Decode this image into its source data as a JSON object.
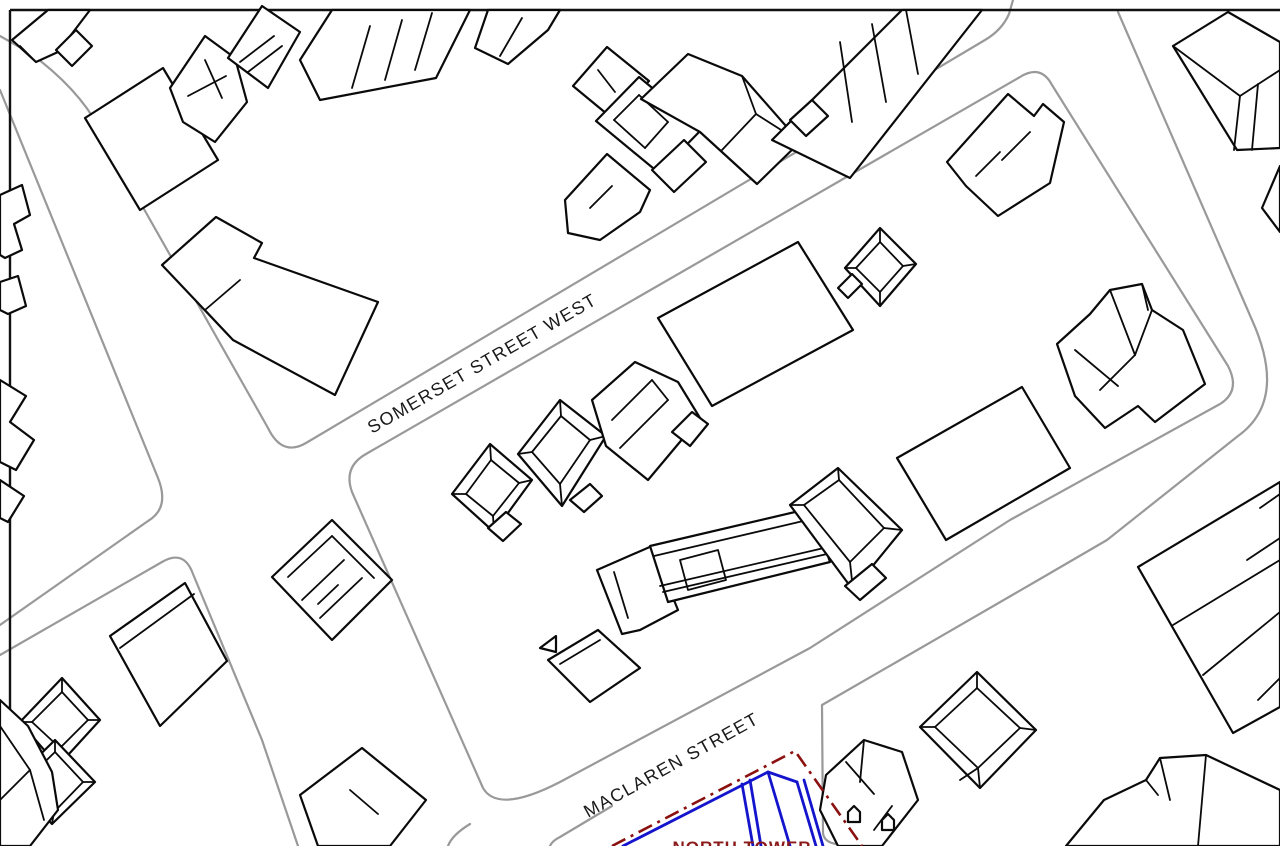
{
  "labels": {
    "somerset": {
      "text": "SOMERSET STREET WEST",
      "x": 372,
      "y": 434,
      "rotate": -30,
      "size": 18,
      "spacing": 1.4,
      "color": "#1a1a1a",
      "weight": "normal",
      "anchor": "start"
    },
    "maclaren": {
      "text": "MACLAREN STREET",
      "x": 588,
      "y": 818,
      "rotate": -29,
      "size": 18,
      "spacing": 1.4,
      "color": "#1a1a1a",
      "weight": "normal",
      "anchor": "start"
    },
    "tower": {
      "text": "NORTH TOWER",
      "x": 742,
      "y": 853,
      "rotate": 0,
      "size": 17,
      "spacing": 1,
      "color": "#8b1a1a",
      "weight": "bold",
      "anchor": "middle"
    }
  },
  "colors": {
    "background": "#ffffff",
    "building_stroke": "#0a0a0a",
    "building_fill": "#ffffff",
    "street_stroke": "#999999",
    "border_stroke": "#111111",
    "boundary_red": "#8b1111",
    "parcel_blue": "#1414cc"
  },
  "strokes": {
    "building_width": 2.2,
    "detail_width": 1.8,
    "street_width": 2.2,
    "border_width": 2.4,
    "red_width": 2.6,
    "blue_width": 2.8,
    "red_dash": "15 6 3 6"
  },
  "map": {
    "border_lines": [
      "10,10 1280,10",
      "10,10 10,846"
    ],
    "streets": [
      {
        "id": "street-topleft-corner-and-somerset-north-curb",
        "d": "M 0 36 L 30 53 Q 86 94 106 142 L 268 428 Q 282 457 306 443 L 985 40 Q 1002 30 1009 14 L 1013 0"
      },
      {
        "id": "street-left-cross-west-curb-upper",
        "d": "M 0 90 L 158 478 Q 170 508 148 521 L 0 625"
      },
      {
        "id": "street-somerset-south-curb-left-and-west-curb-lower",
        "d": "M 0 655 L 162 562 Q 184 549 193 574 L 262 740 L 298 846"
      },
      {
        "id": "street-block-loop-somerset-south-maclaren-north",
        "d": "M 352 492 Q 343 467 366 454 L 1020 77 Q 1041 64 1052 85 L 1228 366 Q 1241 391 1220 404 L 1010 520 L 810 648 L 560 782 Q 498 814 483 788 L 352 492"
      },
      {
        "id": "street-right-cross-east-curb-and-maclaren-south-curb",
        "d": "M 1118 12 L 1252 320 Q 1288 400 1238 436 L 1107 540 L 1040 579 L 900 660 L 822 705 L 823 833 Q 824 842 836 844 L 848 846"
      },
      {
        "id": "street-maclaren-south-curb-west-piece",
        "d": "M 612 806 L 560 837 Q 552 841 550 846"
      },
      {
        "id": "street-maclaren-southwest-corner-piece",
        "d": "M 470 824 Q 452 835 448 846"
      }
    ],
    "buildings": [
      {
        "id": "building-topleft-band",
        "outline": "12,40 48,10 90,10 58,52 36,62",
        "lines": [
          "36,62 20,46"
        ]
      },
      {
        "id": "building-topleft-small-square",
        "outline": "56,50 76,30 92,46 72,66",
        "lines": []
      },
      {
        "id": "building-large-rect-topleft",
        "outline": "85,118 163,68 218,160 140,210",
        "lines": []
      },
      {
        "id": "building-ornate-house-topleft",
        "outline": "170,88 205,36 235,58 247,102 215,142 183,122",
        "lines": [
          "205,60 222,98",
          "188,96 226,76"
        ]
      },
      {
        "id": "building-striped-house-top",
        "outline": "228,58 262,6 300,32 268,88",
        "lines": [
          "240,62 274,36",
          "248,72 282,46"
        ]
      },
      {
        "id": "building-wide-slab-top",
        "outline": "300,60 332,10 470,10 436,78 320,100",
        "lines": [
          "352,88 370,26",
          "385,80 402,20",
          "415,70 432,13"
        ]
      },
      {
        "id": "building-small-slab-top",
        "outline": "475,48 488,10 560,10 548,30 508,64",
        "lines": [
          "500,56 522,18"
        ]
      },
      {
        "id": "building-cluster-top-center-a",
        "outline": "573,86 607,47 649,81 613,119",
        "lines": [
          "598,70 615,92"
        ]
      },
      {
        "id": "building-cluster-top-center-b",
        "outline": "596,121 639,77 702,129 659,173",
        "lines": [
          "614,120 639,95",
          "639,95 668,122",
          "668,122 645,148",
          "645,148 614,120"
        ]
      },
      {
        "id": "building-cluster-top-center-c",
        "outline": "641,99 688,54 742,76 800,142 757,184 700,132",
        "lines": [
          "742,76 756,114",
          "756,114 800,142",
          "756,114 722,150"
        ]
      },
      {
        "id": "building-cluster-top-center-d",
        "outline": "565,200 607,154 650,190 640,212 600,240 568,233",
        "lines": [
          "590,208 612,186"
        ]
      },
      {
        "id": "building-cluster-top-center-e",
        "outline": "652,170 684,140 706,162 674,192",
        "lines": []
      },
      {
        "id": "building-rowhouse-top",
        "outline": "772,140 902,10 982,10 850,178",
        "lines": [
          "840,42 852,122",
          "872,24 886,102",
          "906,10 918,74"
        ]
      },
      {
        "id": "building-rowhouse-top-notch",
        "outline": "790,120 812,100 828,116 806,136",
        "lines": []
      },
      {
        "id": "building-north-east-house",
        "outline": "947,162 1008,94 1034,116 1043,104 1064,122 1050,183 998,216 966,186",
        "lines": [
          "1002,160 1030,132",
          "976,176 1000,152"
        ]
      },
      {
        "id": "building-large-plain-rect-north",
        "outline": "658,318 798,242 853,330 712,406",
        "lines": []
      },
      {
        "id": "building-pyramid-house-north",
        "outline": "845,268 880,228 916,264 880,306",
        "lines": [
          "856,268 880,242",
          "880,242 903,266",
          "903,266 880,292",
          "880,292 856,268",
          "845,268 856,268",
          "880,228 880,242",
          "916,264 903,266",
          "880,306 880,292"
        ]
      },
      {
        "id": "building-pyramid-house-tail",
        "outline": "838,288 852,274 862,284 848,298",
        "lines": []
      },
      {
        "id": "building-wedge-complex-right",
        "outline": "1057,344 1090,314 1110,290 1142,284 1152,310 1183,330 1205,384 1155,422 1138,406 1105,428 1075,396",
        "lines": [
          "1110,290 1135,355",
          "1135,355 1152,310",
          "1135,355 1100,390",
          "1075,350 1118,386",
          "1142,284 1148,310"
        ]
      },
      {
        "id": "building-topright-house",
        "outline": "1173,46 1228,12 1280,42 1280,148 1237,150",
        "lines": [
          "1173,46 1240,96",
          "1240,96 1280,70",
          "1240,96 1234,150",
          "1258,84 1252,150"
        ]
      },
      {
        "id": "building-topright-edge-step",
        "outline": "1262,208 1280,166 1280,232",
        "lines": []
      },
      {
        "id": "building-courtyard-square",
        "outline": "272,577 332,520 392,580 332,640",
        "lines": [
          "288,577 332,536",
          "332,536 374,578",
          "302,600 344,560",
          "320,618 362,578",
          "318,604 338,585"
        ]
      },
      {
        "id": "building-hip-house-1",
        "outline": "452,494 490,444 532,480 494,532",
        "lines": [
          "466,494 491,460",
          "491,460 519,483",
          "519,483 493,516",
          "493,516 466,494",
          "452,494 466,494",
          "490,444 491,460",
          "532,480 519,483",
          "494,532 493,516"
        ]
      },
      {
        "id": "building-hip-house-1-bump",
        "outline": "488,528 506,512 521,524 503,541",
        "lines": []
      },
      {
        "id": "building-hip-house-2",
        "outline": "518,454 560,400 606,436 562,506",
        "lines": [
          "532,452 561,416",
          "561,416 590,440",
          "590,440 560,484",
          "560,484 532,452",
          "518,454 532,452",
          "560,400 561,416",
          "606,436 590,440",
          "562,506 560,484"
        ]
      },
      {
        "id": "building-hip-house-2-bump",
        "outline": "570,500 590,484 602,496 584,512",
        "lines": []
      },
      {
        "id": "building-hip-house-3",
        "outline": "592,400 635,362 678,382 700,418 648,480 606,446",
        "lines": [
          "612,420 652,380",
          "652,380 668,400",
          "620,448 668,400"
        ]
      },
      {
        "id": "building-hip-house-3-notch",
        "outline": "672,432 692,412 708,424 690,446",
        "lines": []
      },
      {
        "id": "building-rowhouse-block-a",
        "outline": "597,570 652,546 678,610 640,630 622,634",
        "lines": [
          "614,572 628,618"
        ]
      },
      {
        "id": "building-rowhouse-block-slab",
        "outline": "650,546 812,508 830,562 668,602",
        "lines": [
          "654,556 816,518",
          "660,586 824,548",
          "663,592 827,554",
          "680,560 718,550 726,580 688,590 680,560"
        ]
      },
      {
        "id": "building-rowhouse-block-hip",
        "outline": "790,505 838,468 902,530 853,590",
        "lines": [
          "804,505 839,480",
          "839,480 884,528",
          "884,528 850,562",
          "850,562 804,505",
          "790,505 804,505",
          "838,468 839,480",
          "902,530 884,528",
          "853,590 850,562"
        ]
      },
      {
        "id": "building-rowhouse-block-hip-bump",
        "outline": "845,586 872,564 886,578 860,600",
        "lines": []
      },
      {
        "id": "building-rowhouse-tail",
        "outline": "548,660 598,630 640,668 590,702",
        "lines": [
          "560,664 600,640"
        ]
      },
      {
        "id": "building-tiny-triangle",
        "outline": "540,648 556,636 556,652",
        "lines": []
      },
      {
        "id": "building-large-plain-rect-south",
        "outline": "897,458 1022,387 1070,468 946,540",
        "lines": []
      },
      {
        "id": "building-diamond-house-south",
        "outline": "920,727 977,672 1036,730 980,788",
        "lines": [
          "935,727 977,688",
          "977,688 1020,728",
          "1020,728 978,768",
          "978,768 935,727",
          "920,727 935,727",
          "977,672 977,688",
          "1036,730 1020,728",
          "980,788 978,768",
          "960,780 978,768"
        ]
      },
      {
        "id": "building-house-near-tower",
        "outline": "826,775 864,740 902,752 918,800 882,846 838,846 820,810",
        "lines": [
          "846,762 874,794",
          "864,740 860,782",
          "892,806 874,830"
        ]
      },
      {
        "id": "building-house-pentagon-mark-1",
        "outline": "848,822 848,812 854,806 860,812 860,822",
        "lines": []
      },
      {
        "id": "building-house-pentagon-mark-2",
        "outline": "882,830 882,820 888,814 894,820 894,830",
        "lines": []
      },
      {
        "id": "building-big-rect-bottom-right",
        "outline": "1138,567 1280,482 1280,707 1233,733",
        "lines": [
          "1173,625 1280,560",
          "1203,675 1280,612"
        ]
      },
      {
        "id": "building-bottom-right-corner",
        "outline": "1104,800 1146,780 1160,758 1206,755 1280,790 1280,846 1066,846",
        "lines": [
          "1160,758 1170,800",
          "1206,755 1198,846",
          "1146,780 1158,795"
        ]
      },
      {
        "id": "building-right-edge-line-a",
        "outline": "",
        "lines": [
          "1247,560 1280,538"
        ]
      },
      {
        "id": "building-right-edge-line-b",
        "outline": "",
        "lines": [
          "1260,508 1280,494"
        ]
      },
      {
        "id": "building-right-edge-step-low",
        "outline": "",
        "lines": [
          "1258,700 1280,678 1280,645"
        ]
      },
      {
        "id": "building-square-bottom-left",
        "outline": "110,636 185,583 227,661 160,726",
        "lines": [
          "120,648 194,594"
        ]
      },
      {
        "id": "building-diamond-house-west-1",
        "outline": "20,722 62,678 100,720 58,766",
        "lines": [
          "32,722 62,692",
          "62,692 88,720",
          "88,720 60,748",
          "60,748 32,722",
          "20,722 32,722",
          "62,678 62,692",
          "100,720 88,720",
          "58,766 60,748"
        ]
      },
      {
        "id": "building-diamond-house-west-2",
        "outline": "12,782 55,740 95,782 52,824",
        "lines": [
          "24,782 55,752",
          "55,752 83,782",
          "83,782 54,812",
          "54,812 24,782",
          "12,782 24,782",
          "55,740 55,752",
          "95,782 83,782",
          "52,824 54,812"
        ]
      },
      {
        "id": "building-spike-bottom-left",
        "outline": "0,700 28,726 52,772 58,810 30,846 0,846",
        "lines": [
          "0,726 30,770",
          "30,770 44,820",
          "30,770 0,800"
        ]
      },
      {
        "id": "building-partial-bottom-center",
        "outline": "300,795 362,748 426,800 390,846 318,846",
        "lines": [
          "350,790 378,814"
        ]
      },
      {
        "id": "building-left-edge-step-1",
        "outline": "0,195 22,185 30,215 14,224 22,250 5,258 0,255",
        "lines": []
      },
      {
        "id": "building-left-edge-step-2",
        "outline": "0,282 18,276 26,306 8,314 0,310",
        "lines": []
      },
      {
        "id": "building-left-edge-step-3",
        "outline": "0,380 26,396 10,422 34,440 16,470 0,462",
        "lines": []
      },
      {
        "id": "building-left-edge-step-4",
        "outline": "0,480 24,496 8,522 0,518",
        "lines": []
      },
      {
        "id": "building-l-shape-upper-left",
        "outline": "162,265 216,217 262,243 254,258 378,302 335,395 233,340",
        "lines": [
          "233,340 205,310 240,280"
        ]
      }
    ],
    "boundary_red": [
      "612,846 795,751 862,846"
    ],
    "blue_lines": [
      "623,846 768,772 790,846",
      "768,772 797,782",
      "797,782 816,846",
      "804,780 823,846",
      "742,784 753,846",
      "750,780 761,846"
    ]
  }
}
